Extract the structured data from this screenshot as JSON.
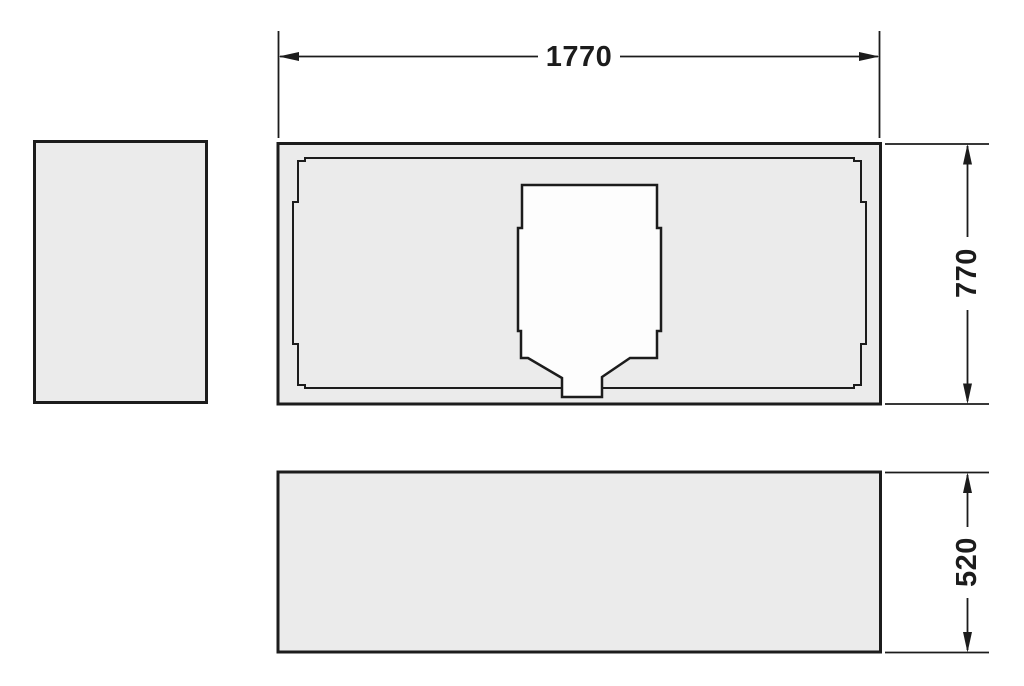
{
  "diagram": {
    "kind": "technical-dimension-drawing",
    "subject": "bathtub-support-panel-views",
    "dimensions": {
      "width": {
        "label": "1770",
        "orientation": "horizontal",
        "position": "top"
      },
      "depth": {
        "label": "770",
        "orientation": "vertical",
        "position": "right-upper"
      },
      "height": {
        "label": "520",
        "orientation": "vertical",
        "position": "right-lower"
      }
    },
    "colors": {
      "line": "#1c1c1c",
      "panel_fill": "#ebebeb",
      "cutout_fill": "#fdfdfd",
      "background": "#ffffff"
    }
  }
}
